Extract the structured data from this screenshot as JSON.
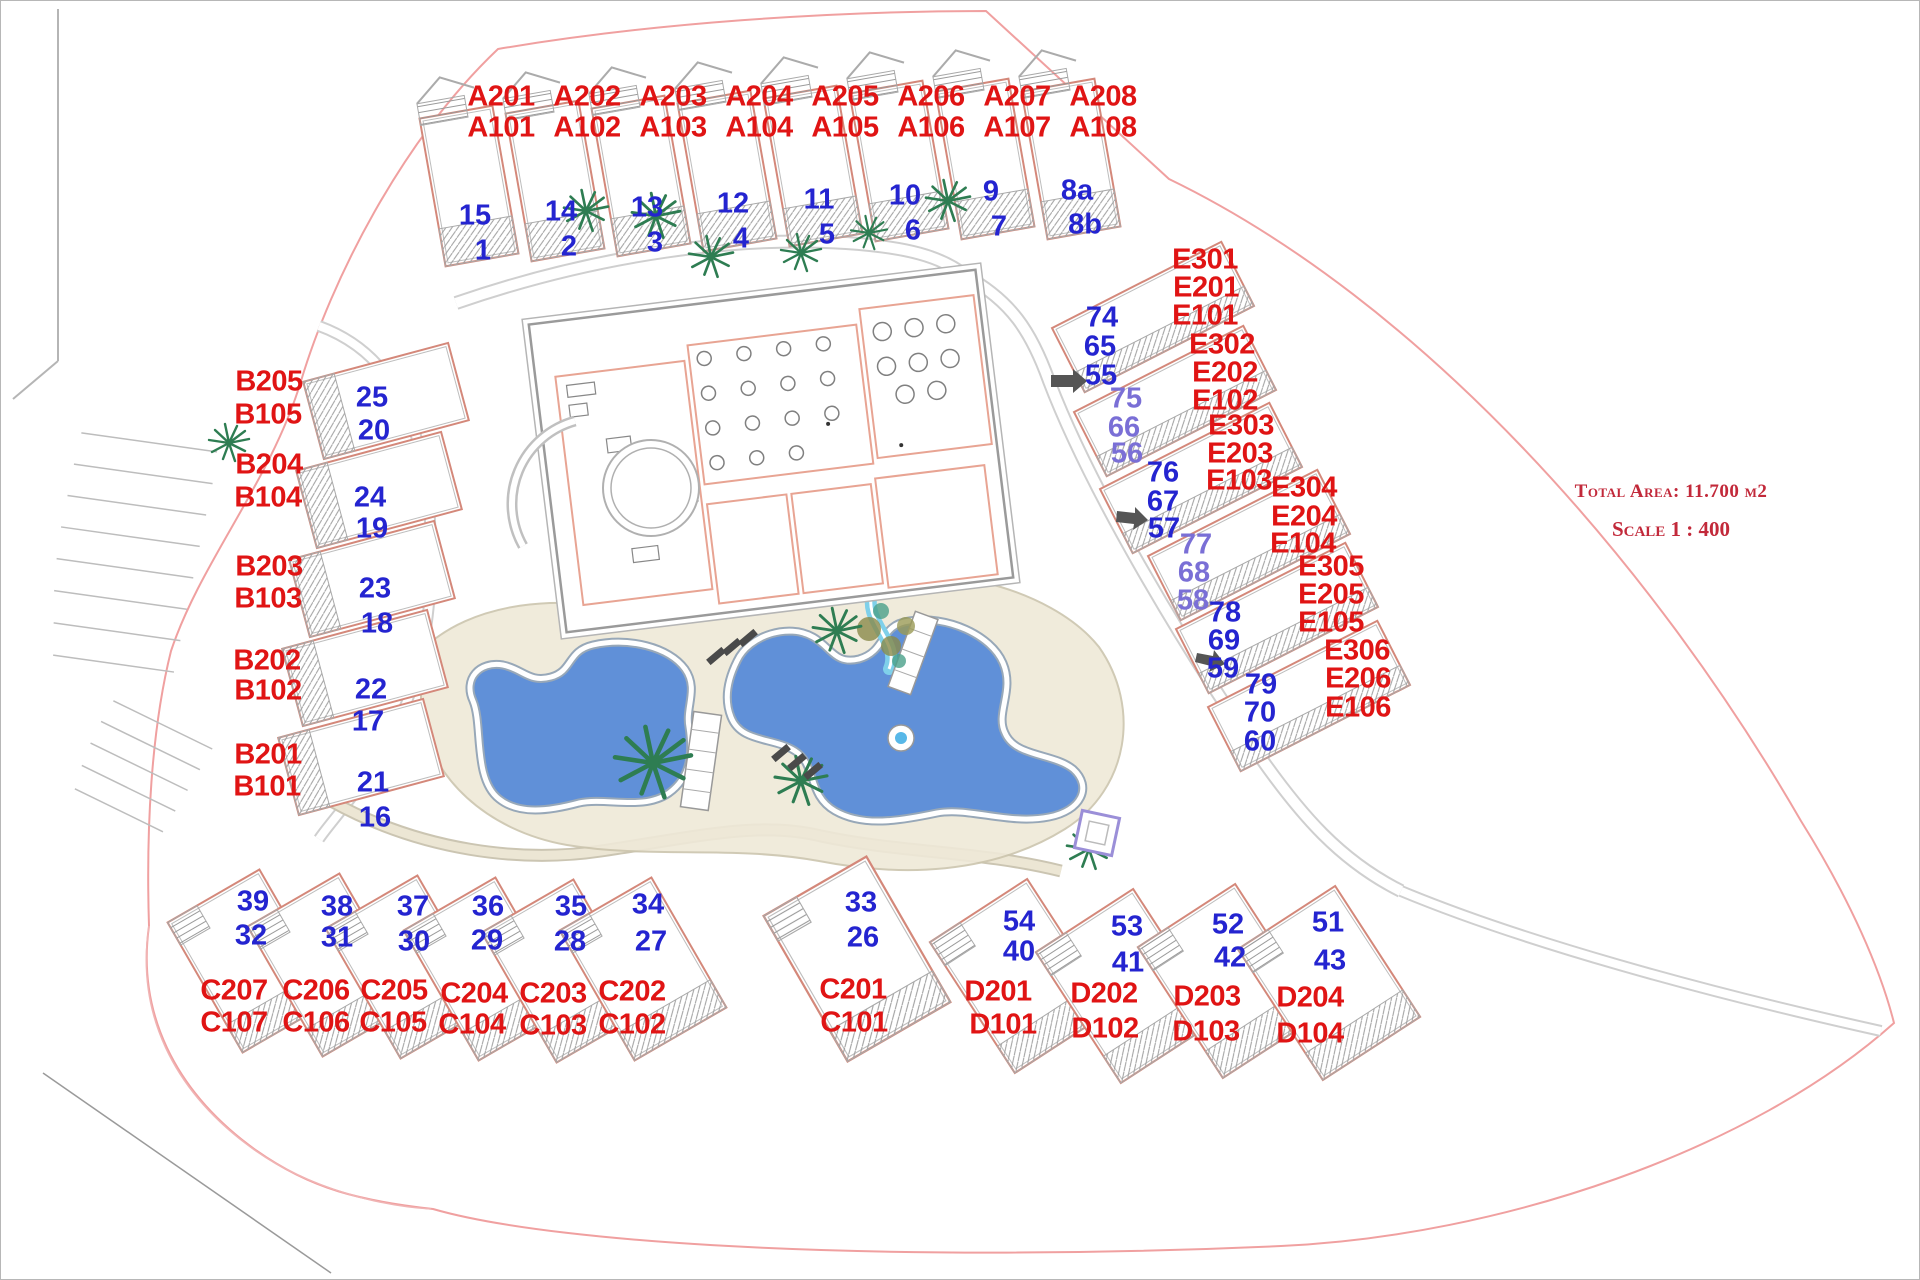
{
  "legend": {
    "total_area": "Total Area:  11.700 m2",
    "scale": "Scale 1 : 400"
  },
  "colors": {
    "unit_label": "#e01414",
    "plot_number": "#2424d0",
    "plot_number_muted": "#7a6fd6",
    "legend_text": "#c2293a",
    "pool_water": "#6090d8",
    "site_boundary": "#f0a0a0",
    "building_outline": "#d4887a",
    "path_gray": "#cfcfcf",
    "palm_green": "#2e7d52"
  },
  "plan_labels": {
    "units": [
      {
        "text": "A201",
        "x": 500,
        "y": 96
      },
      {
        "text": "A202",
        "x": 586,
        "y": 96
      },
      {
        "text": "A203",
        "x": 672,
        "y": 96
      },
      {
        "text": "A204",
        "x": 758,
        "y": 96
      },
      {
        "text": "A205",
        "x": 844,
        "y": 96
      },
      {
        "text": "A206",
        "x": 930,
        "y": 96
      },
      {
        "text": "A207",
        "x": 1016,
        "y": 96
      },
      {
        "text": "A208",
        "x": 1102,
        "y": 96
      },
      {
        "text": "A101",
        "x": 500,
        "y": 127
      },
      {
        "text": "A102",
        "x": 586,
        "y": 127
      },
      {
        "text": "A103",
        "x": 672,
        "y": 127
      },
      {
        "text": "A104",
        "x": 758,
        "y": 127
      },
      {
        "text": "A105",
        "x": 844,
        "y": 127
      },
      {
        "text": "A106",
        "x": 930,
        "y": 127
      },
      {
        "text": "A107",
        "x": 1016,
        "y": 127
      },
      {
        "text": "A108",
        "x": 1102,
        "y": 127
      },
      {
        "text": "B205",
        "x": 268,
        "y": 381
      },
      {
        "text": "B105",
        "x": 267,
        "y": 414
      },
      {
        "text": "B204",
        "x": 268,
        "y": 464
      },
      {
        "text": "B104",
        "x": 267,
        "y": 497
      },
      {
        "text": "B203",
        "x": 268,
        "y": 566
      },
      {
        "text": "B103",
        "x": 267,
        "y": 598
      },
      {
        "text": "B202",
        "x": 266,
        "y": 660
      },
      {
        "text": "B102",
        "x": 267,
        "y": 690
      },
      {
        "text": "B201",
        "x": 267,
        "y": 754
      },
      {
        "text": "B101",
        "x": 266,
        "y": 786
      },
      {
        "text": "E301",
        "x": 1204,
        "y": 259
      },
      {
        "text": "E201",
        "x": 1205,
        "y": 287
      },
      {
        "text": "E101",
        "x": 1204,
        "y": 315
      },
      {
        "text": "E302",
        "x": 1221,
        "y": 344
      },
      {
        "text": "E202",
        "x": 1224,
        "y": 372
      },
      {
        "text": "E102",
        "x": 1224,
        "y": 400
      },
      {
        "text": "E303",
        "x": 1240,
        "y": 425
      },
      {
        "text": "E203",
        "x": 1239,
        "y": 453
      },
      {
        "text": "E103",
        "x": 1238,
        "y": 480
      },
      {
        "text": "E304",
        "x": 1303,
        "y": 487
      },
      {
        "text": "E204",
        "x": 1303,
        "y": 516
      },
      {
        "text": "E104",
        "x": 1302,
        "y": 543
      },
      {
        "text": "E305",
        "x": 1330,
        "y": 566
      },
      {
        "text": "E205",
        "x": 1330,
        "y": 594
      },
      {
        "text": "E105",
        "x": 1330,
        "y": 622
      },
      {
        "text": "E306",
        "x": 1356,
        "y": 650
      },
      {
        "text": "E206",
        "x": 1357,
        "y": 678
      },
      {
        "text": "E106",
        "x": 1357,
        "y": 707
      },
      {
        "text": "C207",
        "x": 233,
        "y": 990
      },
      {
        "text": "C107",
        "x": 233,
        "y": 1022
      },
      {
        "text": "C206",
        "x": 315,
        "y": 990
      },
      {
        "text": "C106",
        "x": 315,
        "y": 1022
      },
      {
        "text": "C205",
        "x": 393,
        "y": 990
      },
      {
        "text": "C105",
        "x": 392,
        "y": 1022
      },
      {
        "text": "C204",
        "x": 473,
        "y": 993
      },
      {
        "text": "C104",
        "x": 471,
        "y": 1024
      },
      {
        "text": "C203",
        "x": 552,
        "y": 993
      },
      {
        "text": "C103",
        "x": 552,
        "y": 1025
      },
      {
        "text": "C202",
        "x": 631,
        "y": 991
      },
      {
        "text": "C102",
        "x": 631,
        "y": 1024
      },
      {
        "text": "C201",
        "x": 852,
        "y": 989
      },
      {
        "text": "C101",
        "x": 853,
        "y": 1022
      },
      {
        "text": "D201",
        "x": 997,
        "y": 991
      },
      {
        "text": "D101",
        "x": 1002,
        "y": 1024
      },
      {
        "text": "D202",
        "x": 1103,
        "y": 993
      },
      {
        "text": "D102",
        "x": 1104,
        "y": 1028
      },
      {
        "text": "D203",
        "x": 1206,
        "y": 996
      },
      {
        "text": "D103",
        "x": 1205,
        "y": 1031
      },
      {
        "text": "D204",
        "x": 1309,
        "y": 997
      },
      {
        "text": "D104",
        "x": 1309,
        "y": 1033
      }
    ],
    "plots": [
      {
        "text": "15",
        "x": 474,
        "y": 215
      },
      {
        "text": "1",
        "x": 482,
        "y": 250
      },
      {
        "text": "14",
        "x": 560,
        "y": 211
      },
      {
        "text": "2",
        "x": 568,
        "y": 246
      },
      {
        "text": "13",
        "x": 646,
        "y": 207
      },
      {
        "text": "3",
        "x": 654,
        "y": 242
      },
      {
        "text": "12",
        "x": 732,
        "y": 203
      },
      {
        "text": "4",
        "x": 740,
        "y": 238
      },
      {
        "text": "11",
        "x": 818,
        "y": 199
      },
      {
        "text": "5",
        "x": 826,
        "y": 234
      },
      {
        "text": "10",
        "x": 904,
        "y": 195
      },
      {
        "text": "6",
        "x": 912,
        "y": 230
      },
      {
        "text": "9",
        "x": 990,
        "y": 191
      },
      {
        "text": "7",
        "x": 998,
        "y": 226
      },
      {
        "text": "8a",
        "x": 1076,
        "y": 190
      },
      {
        "text": "8b",
        "x": 1084,
        "y": 224
      },
      {
        "text": "25",
        "x": 371,
        "y": 397
      },
      {
        "text": "20",
        "x": 373,
        "y": 430
      },
      {
        "text": "24",
        "x": 369,
        "y": 497
      },
      {
        "text": "19",
        "x": 371,
        "y": 528
      },
      {
        "text": "23",
        "x": 374,
        "y": 588
      },
      {
        "text": "18",
        "x": 376,
        "y": 623
      },
      {
        "text": "22",
        "x": 370,
        "y": 689
      },
      {
        "text": "17",
        "x": 367,
        "y": 721
      },
      {
        "text": "21",
        "x": 372,
        "y": 782
      },
      {
        "text": "16",
        "x": 374,
        "y": 817
      },
      {
        "text": "74",
        "x": 1101,
        "y": 317
      },
      {
        "text": "65",
        "x": 1099,
        "y": 346
      },
      {
        "text": "55",
        "x": 1100,
        "y": 375
      },
      {
        "text": "75",
        "x": 1125,
        "y": 398,
        "muted": true
      },
      {
        "text": "66",
        "x": 1123,
        "y": 427,
        "muted": true
      },
      {
        "text": "56",
        "x": 1126,
        "y": 453,
        "muted": true
      },
      {
        "text": "76",
        "x": 1162,
        "y": 472
      },
      {
        "text": "67",
        "x": 1162,
        "y": 501
      },
      {
        "text": "57",
        "x": 1163,
        "y": 528
      },
      {
        "text": "77",
        "x": 1195,
        "y": 544,
        "muted": true
      },
      {
        "text": "68",
        "x": 1193,
        "y": 572,
        "muted": true
      },
      {
        "text": "58",
        "x": 1192,
        "y": 600,
        "muted": true
      },
      {
        "text": "78",
        "x": 1224,
        "y": 612
      },
      {
        "text": "69",
        "x": 1223,
        "y": 640
      },
      {
        "text": "59",
        "x": 1222,
        "y": 668
      },
      {
        "text": "79",
        "x": 1260,
        "y": 684
      },
      {
        "text": "70",
        "x": 1259,
        "y": 712
      },
      {
        "text": "60",
        "x": 1259,
        "y": 741
      },
      {
        "text": "39",
        "x": 252,
        "y": 901
      },
      {
        "text": "32",
        "x": 250,
        "y": 935
      },
      {
        "text": "38",
        "x": 336,
        "y": 906
      },
      {
        "text": "31",
        "x": 336,
        "y": 937
      },
      {
        "text": "37",
        "x": 412,
        "y": 906
      },
      {
        "text": "30",
        "x": 413,
        "y": 941
      },
      {
        "text": "36",
        "x": 487,
        "y": 906
      },
      {
        "text": "29",
        "x": 486,
        "y": 940
      },
      {
        "text": "35",
        "x": 570,
        "y": 906
      },
      {
        "text": "28",
        "x": 569,
        "y": 941
      },
      {
        "text": "34",
        "x": 647,
        "y": 904
      },
      {
        "text": "27",
        "x": 650,
        "y": 941
      },
      {
        "text": "33",
        "x": 860,
        "y": 902
      },
      {
        "text": "26",
        "x": 862,
        "y": 937
      },
      {
        "text": "54",
        "x": 1018,
        "y": 921
      },
      {
        "text": "40",
        "x": 1018,
        "y": 951
      },
      {
        "text": "53",
        "x": 1126,
        "y": 926
      },
      {
        "text": "41",
        "x": 1127,
        "y": 962
      },
      {
        "text": "52",
        "x": 1227,
        "y": 924
      },
      {
        "text": "42",
        "x": 1229,
        "y": 957
      },
      {
        "text": "51",
        "x": 1327,
        "y": 922
      },
      {
        "text": "43",
        "x": 1329,
        "y": 960
      }
    ]
  }
}
